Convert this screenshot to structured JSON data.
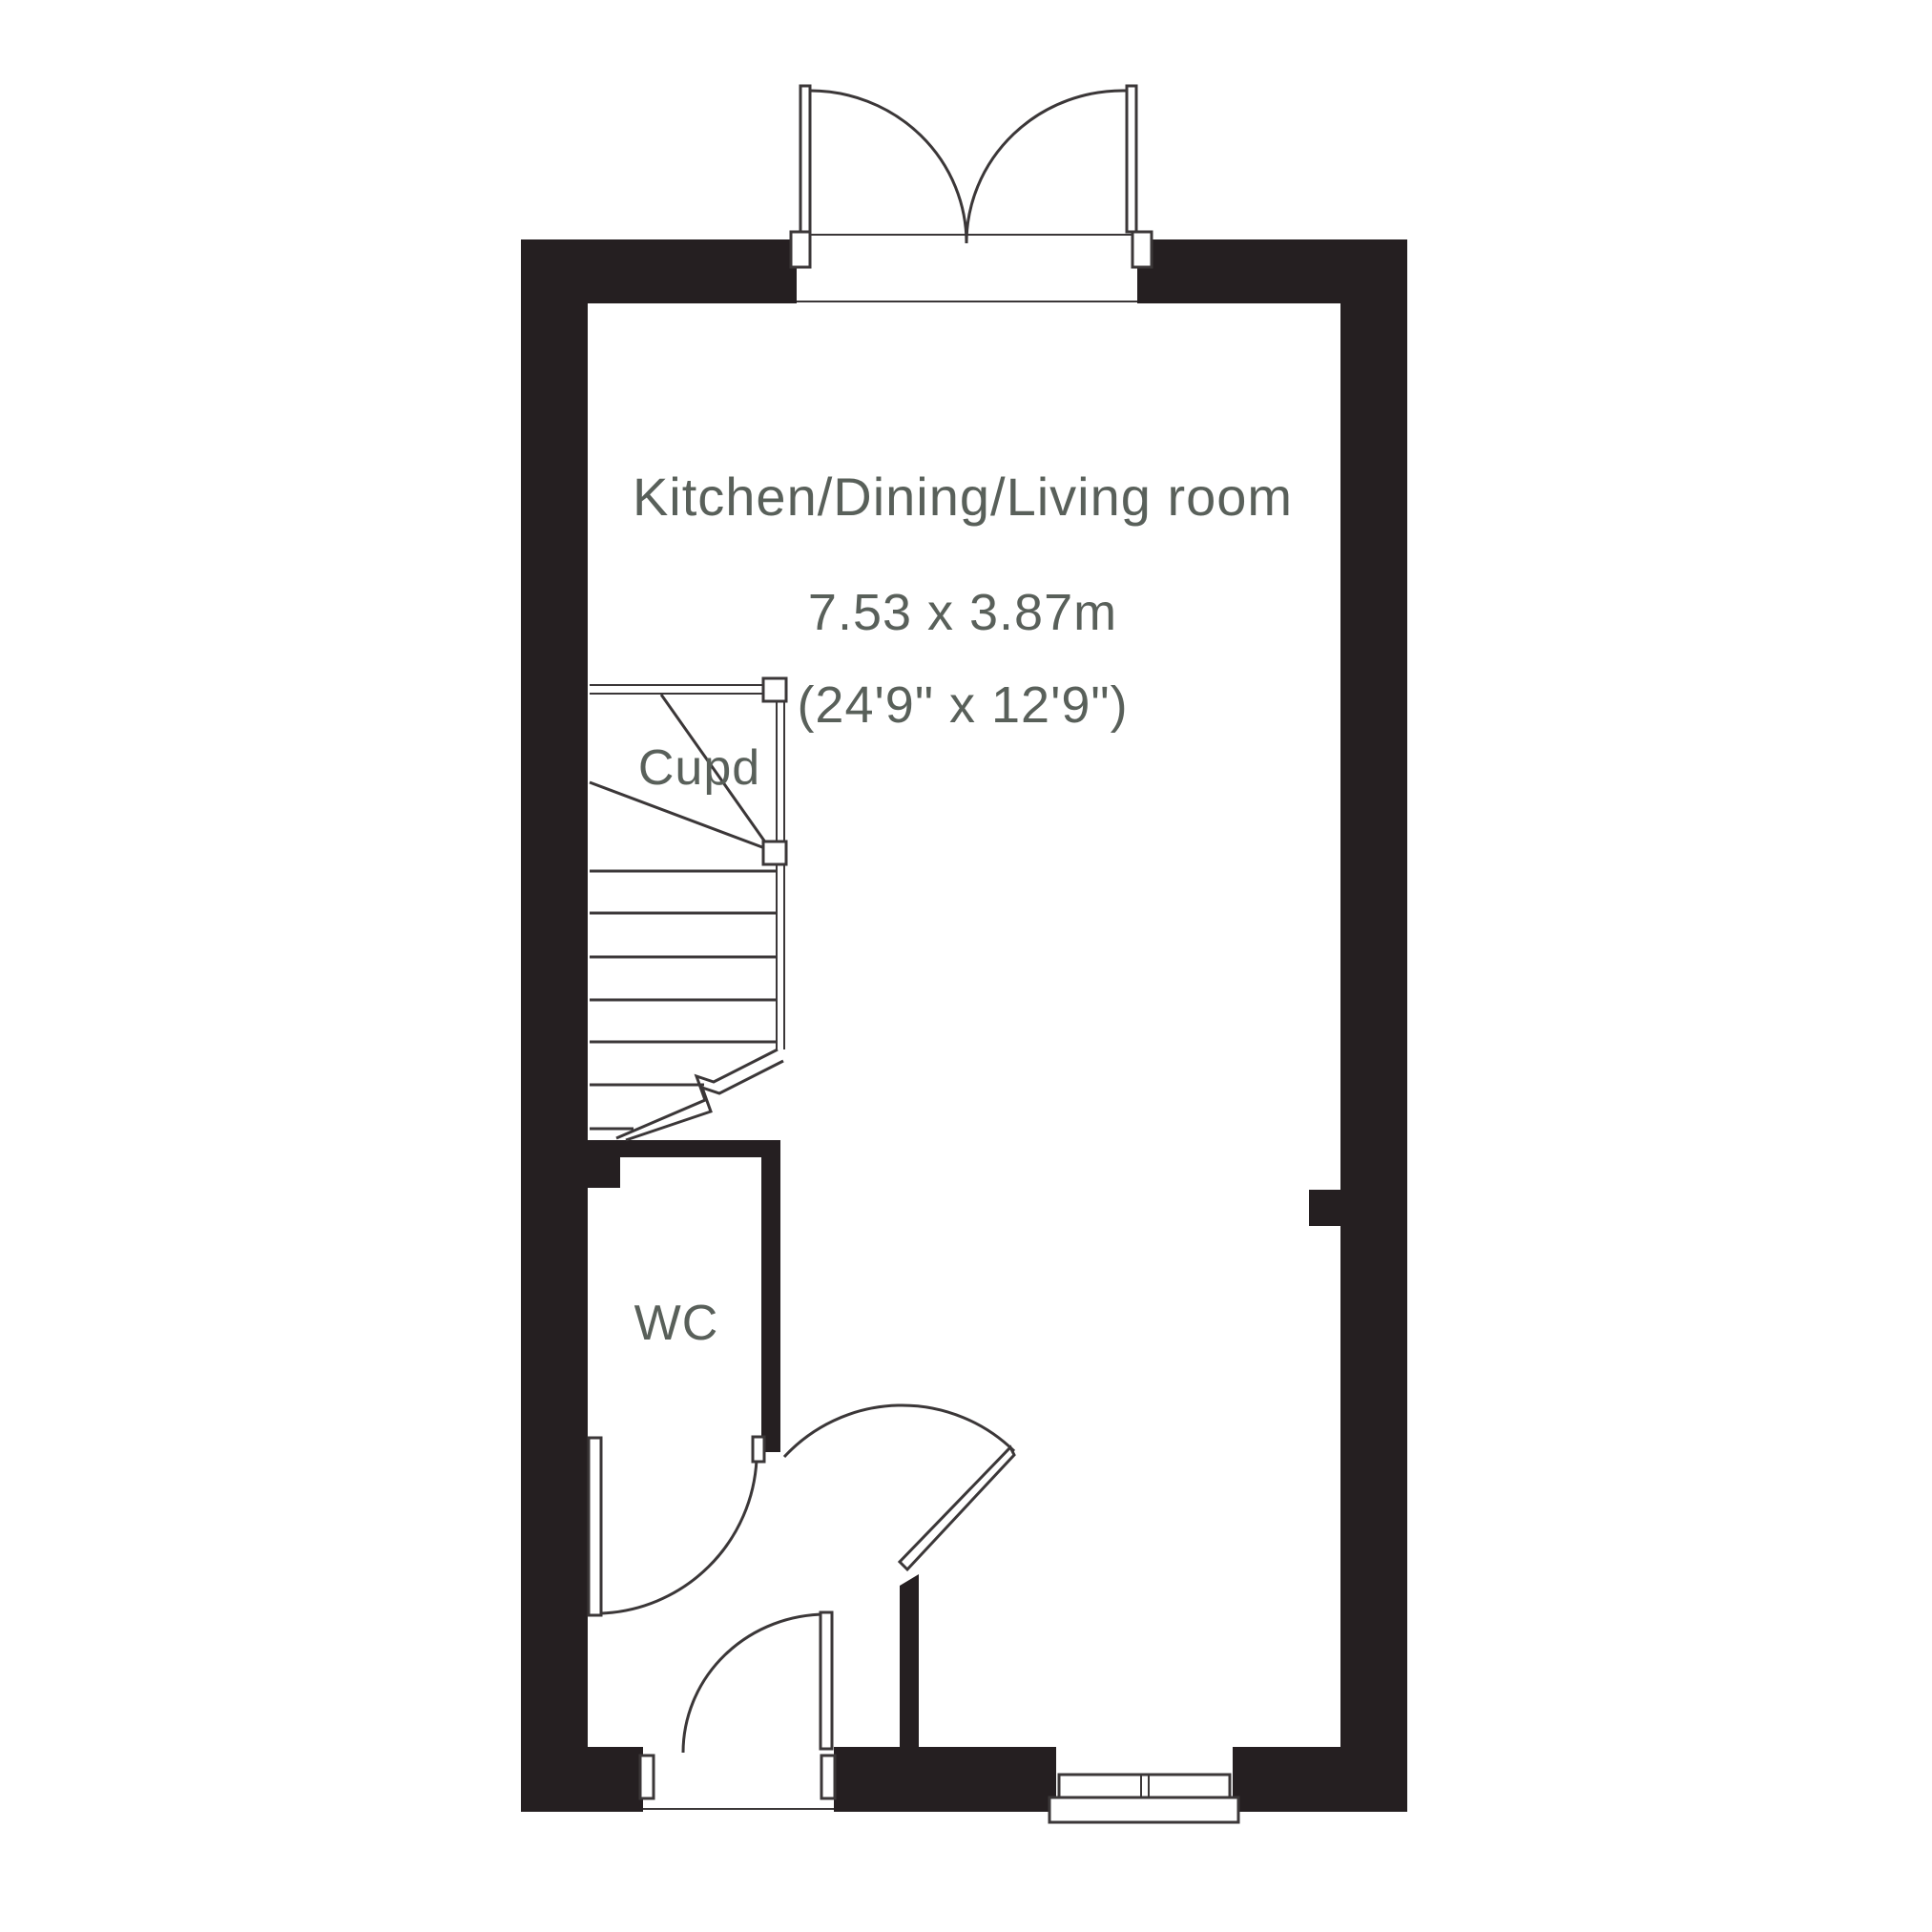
{
  "page": {
    "background": "#ffffff"
  },
  "colors": {
    "wall": "#251f21",
    "line": "#3b3738",
    "text": "#59605a"
  },
  "floorplan": {
    "room": {
      "name": "Kitchen/Dining/Living room",
      "size_metric": "7.53 x 3.87m",
      "size_imperial": "(24'9\" x 12'9\")"
    },
    "cupboard_label": "Cupd",
    "wc_label": "WC"
  }
}
